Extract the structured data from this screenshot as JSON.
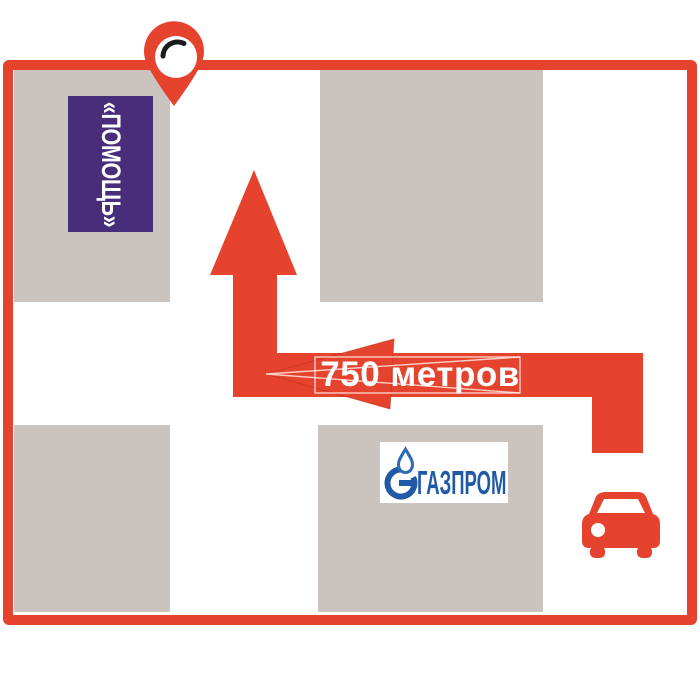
{
  "map": {
    "distance_label": "750 метров",
    "help_sign_label": "«ПОМОЩЬ»",
    "gazprom_label": "ГАЗПРОМ"
  },
  "icons": {
    "location_pin": "map location pin with white circle and black highlight arc",
    "car": "front-view car pictogram",
    "gazprom_flame": "gazprom G-ring with flame emblem",
    "up_arrow": "route arrow pointing up",
    "left_arrow": "route arrowhead pointing left"
  },
  "colors": {
    "route_red": "#e5432d",
    "building_gray": "#cac3be",
    "help_purple": "#482d7a",
    "gazprom_blue": "#205aa7",
    "pin_arc_black": "#1b1b1b",
    "background": "#ffffff"
  }
}
